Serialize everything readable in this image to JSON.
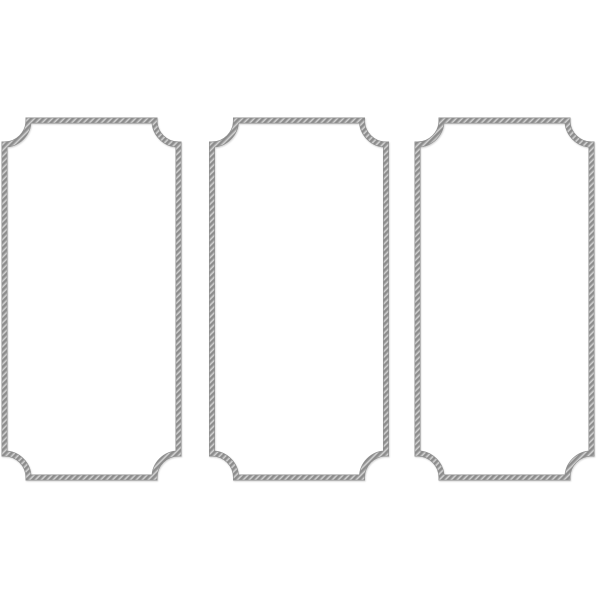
{
  "page": {
    "background_color": "#ffffff"
  },
  "artwork": {
    "description": "Three vertical rope-style panel moulding frames with concave scalloped corners on a plain white background",
    "frame_count": 3,
    "rope_base_color": "#a9a9a9",
    "rope_dark_color": "#8c8c8c",
    "rope_light_color": "#d4d4d4",
    "rope_outline_color": "#8f8f8f",
    "shadow_color": "#000000",
    "shadow_opacity": 0.18,
    "corner_radius": 24,
    "stroke_width": 4.6,
    "outline_width": 6,
    "frames": [
      {
        "name": "rope-frame-left",
        "left": 4.5,
        "top": 120.5,
        "right": 178.5,
        "bottom": 477.5
      },
      {
        "name": "rope-frame-middle",
        "left": 212,
        "top": 120.5,
        "right": 386,
        "bottom": 477.5
      },
      {
        "name": "rope-frame-right",
        "left": 417.5,
        "top": 120.5,
        "right": 591.5,
        "bottom": 477.5
      }
    ]
  }
}
